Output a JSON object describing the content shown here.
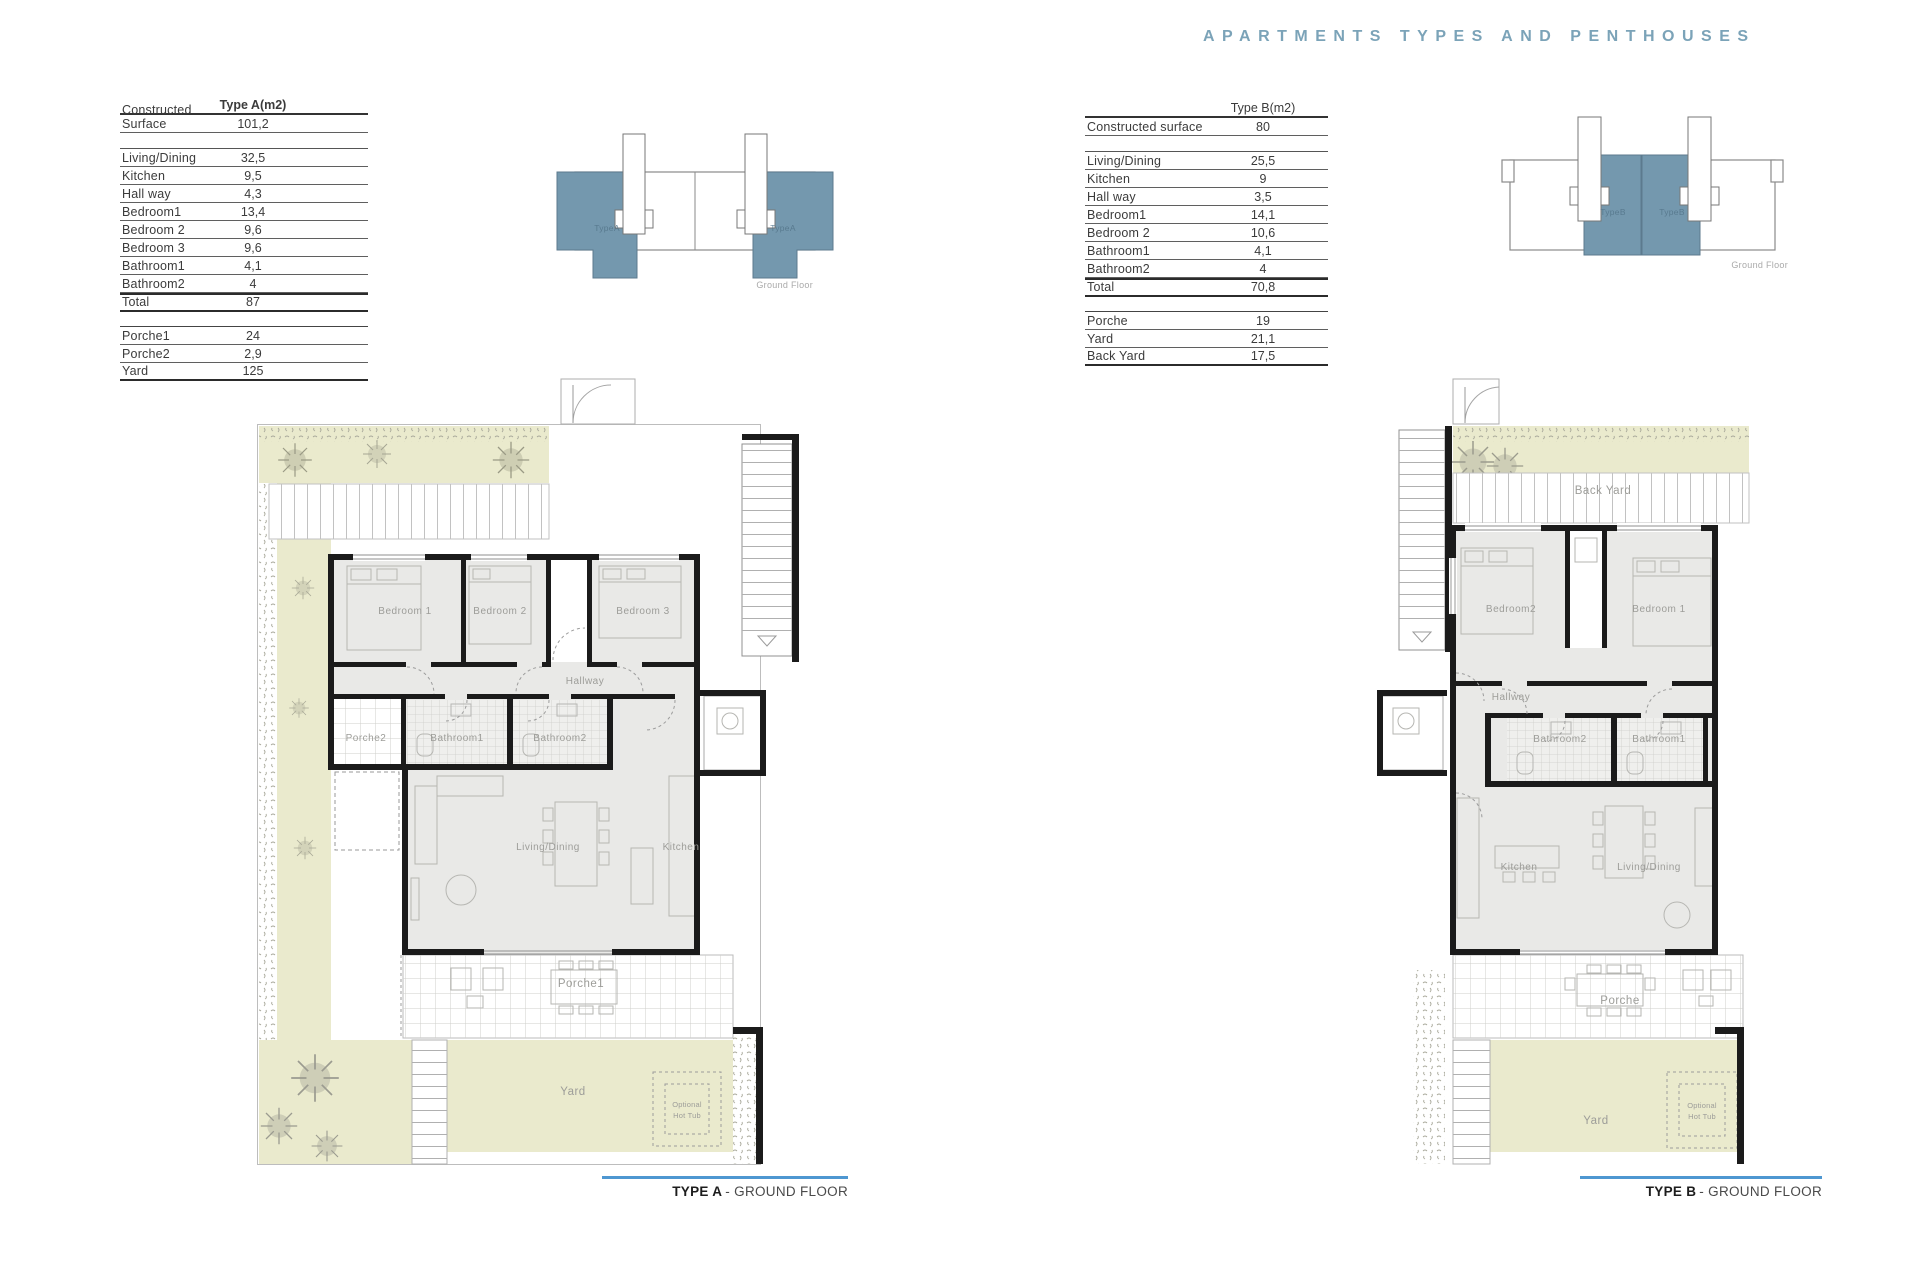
{
  "page": {
    "title": "APARTMENTS TYPES AND PENTHOUSES"
  },
  "colors": {
    "accent": "#7ba3b8",
    "caption_line": "#4e97d1",
    "unit_blue": "#7498ae",
    "garden_green": "#eaeacd",
    "room_gray": "#e9e9e7"
  },
  "type_a": {
    "table": {
      "header": "Type A(m2)",
      "surface": {
        "label": "Constructed Surface",
        "value": "101,2"
      },
      "rooms": [
        {
          "label": "Living/Dining",
          "value": "32,5"
        },
        {
          "label": "Kitchen",
          "value": "9,5"
        },
        {
          "label": "Hall way",
          "value": "4,3"
        },
        {
          "label": "Bedroom1",
          "value": "13,4"
        },
        {
          "label": "Bedroom 2",
          "value": "9,6"
        },
        {
          "label": "Bedroom 3",
          "value": "9,6"
        },
        {
          "label": "Bathroom1",
          "value": "4,1"
        },
        {
          "label": "Bathroom2",
          "value": "4"
        }
      ],
      "total": {
        "label": "Total",
        "value": "87"
      },
      "outdoor": [
        {
          "label": "Porche1",
          "value": "24"
        },
        {
          "label": "Porche2",
          "value": "2,9"
        },
        {
          "label": "Yard",
          "value": "125"
        }
      ]
    },
    "locator": {
      "unit_label": "TypeA",
      "floor_label": "Ground Floor"
    },
    "plan": {
      "bedroom1": "Bedroom 1",
      "bedroom2": "Bedroom 2",
      "bedroom3": "Bedroom 3",
      "hallway": "Hallway",
      "porche2": "Porche2",
      "bathroom1": "Bathroom1",
      "bathroom2": "Bathroom2",
      "living": "Living/Dining",
      "kitchen": "Kitchen",
      "porche1": "Porche1",
      "yard": "Yard",
      "hot_tub_line1": "Optional",
      "hot_tub_line2": "Hot Tub"
    },
    "caption": {
      "name": "TYPE A",
      "suffix": "- GROUND FLOOR"
    }
  },
  "type_b": {
    "table": {
      "header": "Type B(m2)",
      "surface": {
        "label": "Constructed surface",
        "value": "80"
      },
      "rooms": [
        {
          "label": "Living/Dining",
          "value": "25,5"
        },
        {
          "label": "Kitchen",
          "value": "9"
        },
        {
          "label": "Hall way",
          "value": "3,5"
        },
        {
          "label": "Bedroom1",
          "value": "14,1"
        },
        {
          "label": "Bedroom 2",
          "value": "10,6"
        },
        {
          "label": "Bathroom1",
          "value": "4,1"
        },
        {
          "label": "Bathroom2",
          "value": "4"
        }
      ],
      "total": {
        "label": "Total",
        "value": "70,8"
      },
      "outdoor": [
        {
          "label": "Porche",
          "value": "19"
        },
        {
          "label": "Yard",
          "value": "21,1"
        },
        {
          "label": "Back Yard",
          "value": "17,5"
        }
      ]
    },
    "locator": {
      "unit_label": "TypeB",
      "floor_label": "Ground Floor"
    },
    "plan": {
      "back_yard": "Back Yard",
      "bedroom2": "Bedroom2",
      "bedroom1": "Bedroom 1",
      "hallway": "Hallway",
      "bathroom2": "Bathroom2",
      "bathroom1": "Bathroom1",
      "kitchen": "Kitchen",
      "living": "Living/Dining",
      "porche": "Porche",
      "yard": "Yard",
      "hot_tub_line1": "Optional",
      "hot_tub_line2": "Hot Tub"
    },
    "caption": {
      "name": "TYPE B",
      "suffix": "- GROUND FLOOR"
    }
  }
}
